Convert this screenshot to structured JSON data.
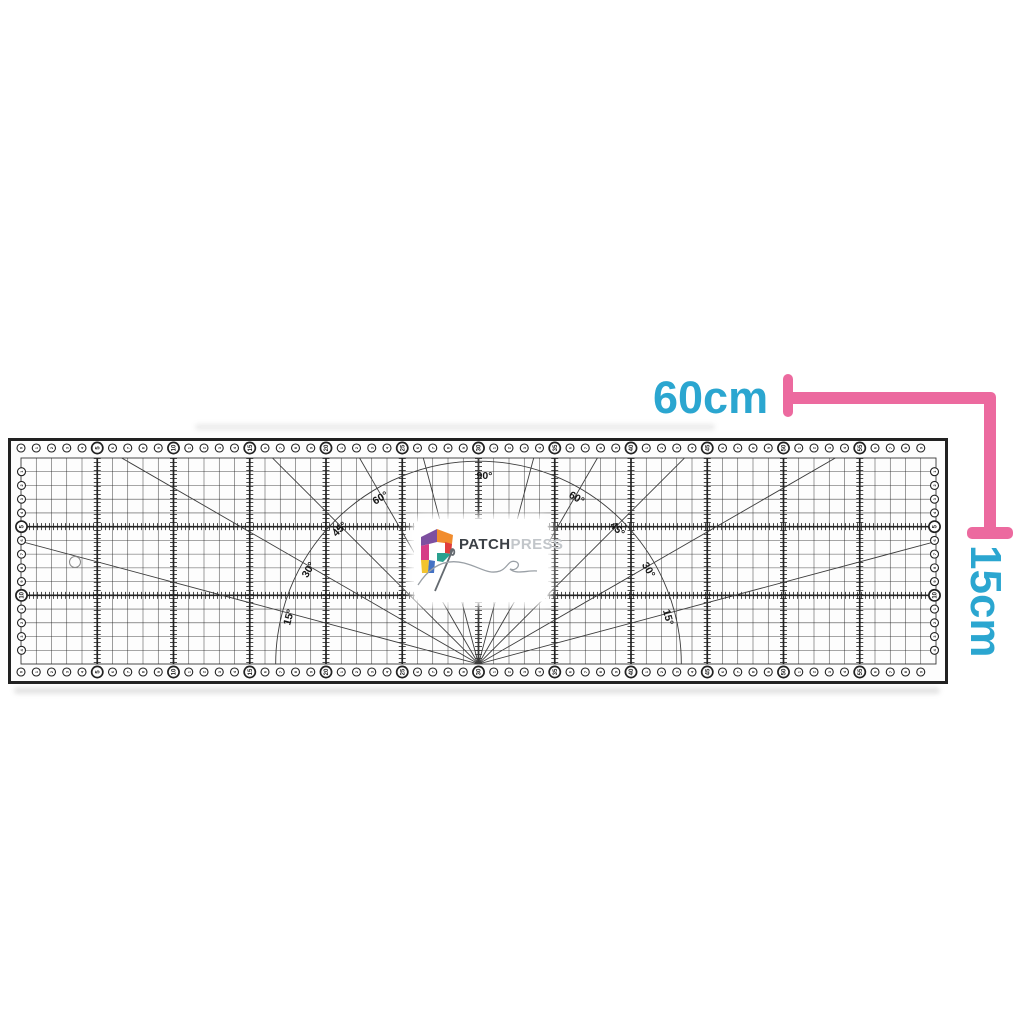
{
  "page": {
    "background": "#ffffff"
  },
  "annotations": {
    "width_label": "60cm",
    "height_label": "15cm",
    "text_color": "#2ba6d0",
    "bracket_color": "#ec6a9f"
  },
  "logo": {
    "brand_bold": "PATCH",
    "brand_light": "PRESS",
    "bold_color": "#3b4046",
    "light_color": "#c2c6ca",
    "thread_color": "#9aa0a6",
    "needle_color": "#646a70",
    "mark": [
      "#7d4fa0",
      "#f18c2d",
      "#d63c86",
      "#e03c3c",
      "#2aa08f",
      "#f3c42f",
      "#4472c4"
    ]
  },
  "ruler": {
    "length_cm": 60,
    "height_cm": 15,
    "bold_every_cm": 5,
    "line_color": "#222222",
    "accent_line_color": "#3c3c3c",
    "edge_holes": {
      "top_count": 59,
      "side_count": 14
    },
    "fan_angles_deg": [
      15,
      30,
      45,
      60,
      75,
      90
    ],
    "arc_radius_cm": 13.3,
    "angle_label_suffix": "°",
    "angle_labels": [
      {
        "text": "90°",
        "deg": 90,
        "side": "center"
      },
      {
        "text": "60°",
        "deg": 60,
        "side": "left"
      },
      {
        "text": "45°",
        "deg": 45,
        "side": "left"
      },
      {
        "text": "30°",
        "deg": 30,
        "side": "left"
      },
      {
        "text": "15°",
        "deg": 15,
        "side": "left"
      },
      {
        "text": "60°",
        "deg": 60,
        "side": "right"
      },
      {
        "text": "45°",
        "deg": 45,
        "side": "right"
      },
      {
        "text": "30°",
        "deg": 30,
        "side": "right"
      },
      {
        "text": "15°",
        "deg": 15,
        "side": "right"
      }
    ],
    "has_hanging_hole": true
  }
}
